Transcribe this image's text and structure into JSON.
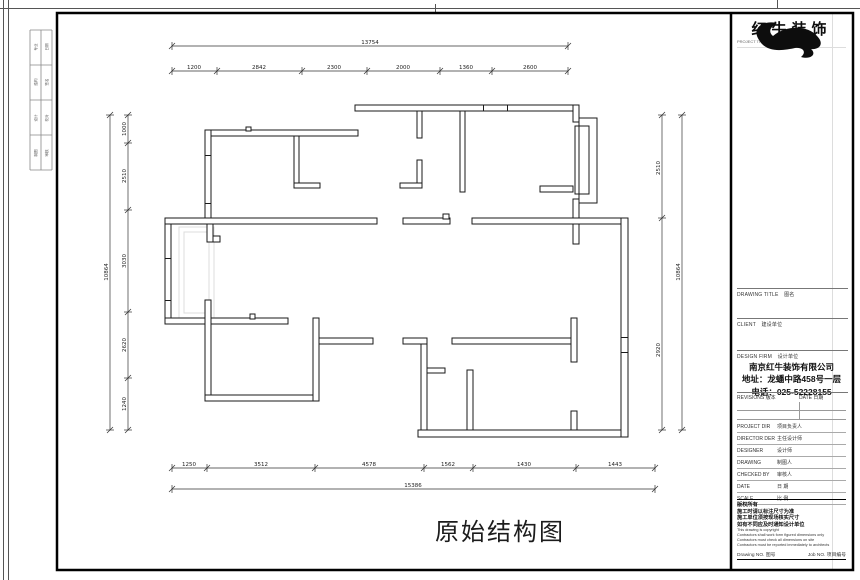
{
  "drawing_title": "原始结构图",
  "logo": {
    "brand": "红牛装饰",
    "subtitle": "PROJECT TITLE  项目名称"
  },
  "frame": {
    "reg_rows": [
      [
        "专业",
        "日期"
      ],
      [
        "结构",
        "签名"
      ],
      [
        "设计",
        "校对"
      ],
      [
        "制图",
        "审核"
      ]
    ]
  },
  "title_block": {
    "sections": [
      {
        "en": "DRAWING TITLE",
        "zh": "图名"
      },
      {
        "en": "CLIENT",
        "zh": "建设单位"
      },
      {
        "en": "DESIGN FIRM",
        "zh": "设计单位"
      }
    ],
    "company": {
      "name": "南京红牛装饰有限公司",
      "address": "地址：龙蟠中路458号一层",
      "phone": "电话：025-52228155"
    },
    "revisions": {
      "en": "REVISIONS",
      "zh": "版本",
      "date_en": "DATE",
      "date_zh": "日期"
    },
    "personnel": [
      {
        "en": "PROJECT DIR",
        "zh": "项目负责人"
      },
      {
        "en": "DIRECTOR DER",
        "zh": "主任设计师"
      },
      {
        "en": "DESIGNER",
        "zh": "设计师"
      },
      {
        "en": "DRAWING",
        "zh": "制图人"
      },
      {
        "en": "CHECKED BY",
        "zh": "审核人"
      },
      {
        "en": "DATE",
        "zh": "日 期"
      },
      {
        "en": "SCALE",
        "zh": "比 例"
      }
    ],
    "notes": [
      "版权所有",
      "施工时请以标注尺寸为准",
      "施工单位须按现场核实尺寸",
      "如有不同应及时通知设计单位",
      "This drawing is copyright",
      "Contractors shall work form figured dimensions only",
      "Contractors must check all dimensions on site",
      "Contractors must be reported immediately to architects"
    ],
    "doc_numbers": {
      "drawing_en": "Drawing NO.",
      "drawing_zh": "图号",
      "job_en": "Job NO.",
      "job_zh": "项目编号"
    }
  },
  "plan": {
    "dimensions": {
      "top_overall": "13754",
      "top_segments": [
        "1200",
        "2842",
        "2300",
        "2000",
        "1360",
        "2600"
      ],
      "bottom_overall": "15386",
      "bottom_segments": [
        "1250",
        "3512",
        "4578",
        "1562",
        "1430",
        "1443"
      ],
      "left_overall": "10864",
      "left_segments": [
        "1000",
        "2510",
        "3030",
        "2620",
        "1240"
      ],
      "right_overall": "10864",
      "right_segments": [
        "2510",
        "2920"
      ]
    }
  }
}
